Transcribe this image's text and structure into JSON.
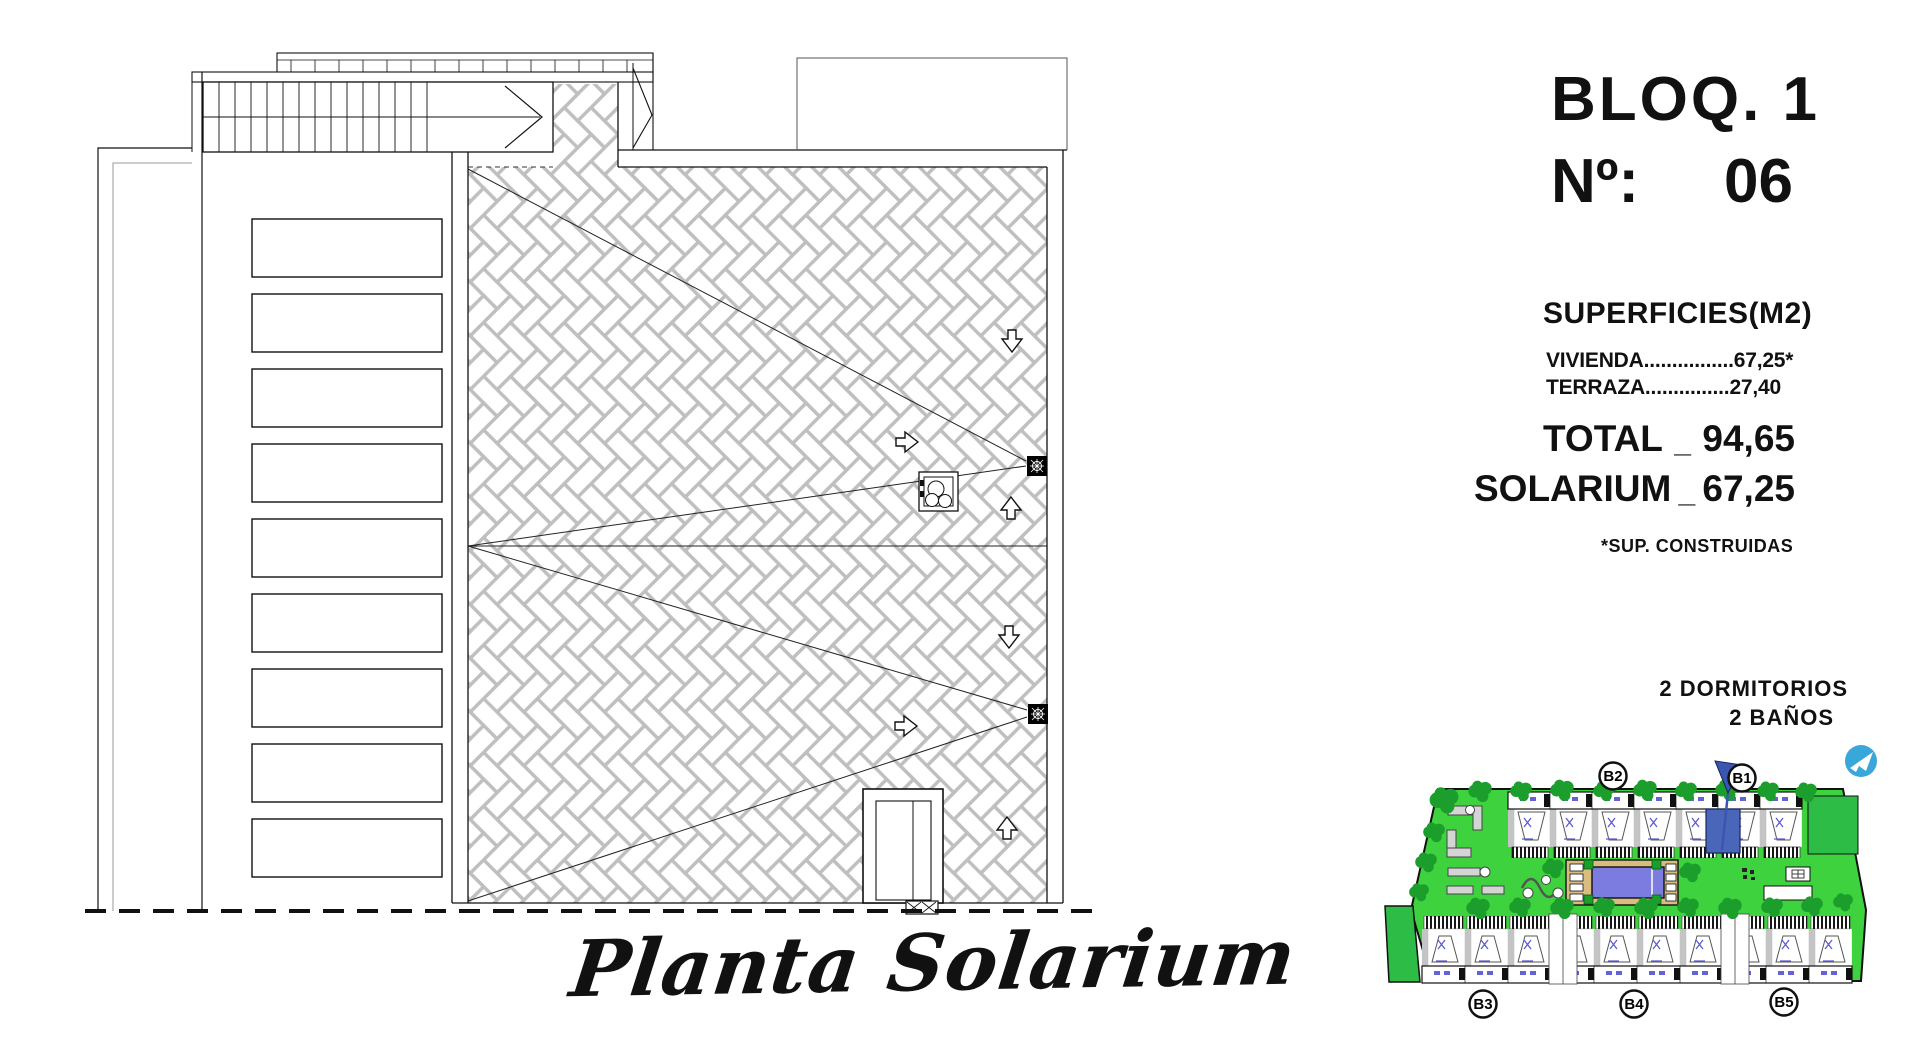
{
  "header": {
    "bloq": "BLOQ. 1",
    "numero_label": "Nº:",
    "numero_value": "06"
  },
  "surfaces": {
    "title": "SUPERFICIES(M2)",
    "vivienda": "VIVIENDA................67,25*",
    "terraza": "TERRAZA...............27,40",
    "total_label": "TOTAL",
    "total_sep": "_",
    "total_value": "94,65",
    "solarium_label": "SOLARIUM",
    "solarium_sep": "_",
    "solarium_value": "67,25",
    "footnote": "*SUP. CONSTRUIDAS"
  },
  "features": {
    "dormitorios": "2 DORMITORIOS",
    "banos": "2 BAÑOS"
  },
  "caption": "Planta Solarium",
  "siteplan": {
    "labels": [
      "B2",
      "B1",
      "B3",
      "B4",
      "B5"
    ]
  },
  "colors": {
    "lawn": "#3fd23f",
    "lawn_dark": "#2dbd46",
    "tree": "#1b9e2c",
    "pool": "#7b7be0",
    "deck": "#d9bd7f",
    "highlight_unit": "#4a66b8",
    "flag": "#3a56b0",
    "icon_blue": "#39a7d9",
    "mortar": "#bfbfbf",
    "furniture": "#5b5bd0"
  }
}
